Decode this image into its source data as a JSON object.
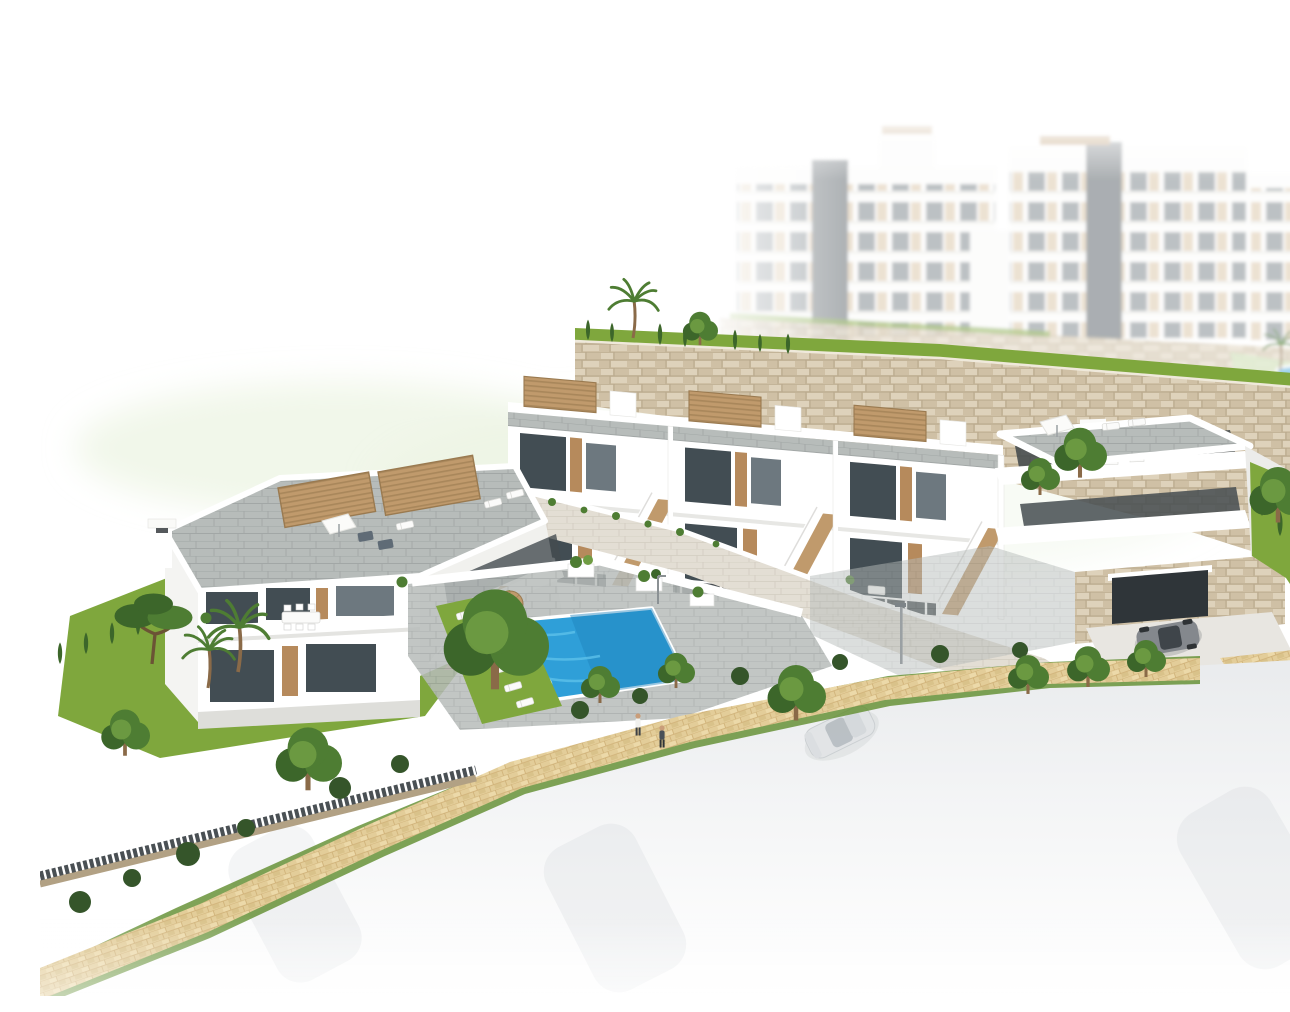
{
  "scene": {
    "caption": "Aerial 3D architectural rendering of a white Mediterranean hillside residential development: a front row of terraced townhouses with tan rooftop pergolas and external staircases, a duplex villa on the left, a communal blue swimming pool with sun loungers and straw parasols, landscaped gardens with pines, palms and cypresses, a beige cobbled footpath, a stone retaining wall, hazy white apartment blocks on the hill behind, and a faded white street with cars in the foreground.",
    "setting": "hillside residential development render, white background",
    "inventory": {
      "background_apartment_blocks": 3,
      "townhouse_units_front_row": 4,
      "corner_townhouse": 1,
      "detached_villa_duplex": 1,
      "swimming_pools": 2,
      "sun_loungers_poolside": 6,
      "parasols_poolside": 2,
      "rooftop_pergolas": 6,
      "pedestrians_on_path": 2,
      "person_on_lounger": 1,
      "person_in_pool": 1,
      "parked_cars_faded": 3,
      "sedan_on_street": 1,
      "sports_car_at_garage": 1,
      "street_lamps": 2
    }
  },
  "colors": {
    "background": "#ffffff",
    "haze_green": "#e7f1dc",
    "building_white": "#ffffff",
    "building_shade": "#f1f1ee",
    "building_dark_face": "#e4e4e1",
    "glass_dark": "#424d53",
    "glass_mid": "#6d787f",
    "frame_dark": "#2e3437",
    "wood_tan": "#c09a6c",
    "wood_dark": "#9a7a50",
    "door_tan": "#b68a5c",
    "roof_paver": "#b7bcba",
    "roof_paver_line": "#a0a6a4",
    "stone_base": "#cfc0a5",
    "stone_dark": "#b2a184",
    "stone_light": "#ded2bb",
    "wall_light": "#e3ded4",
    "wall_light_line": "#cdc7ba",
    "pool_blue": "#2f9fd8",
    "pool_blue_light": "#5cc0ea",
    "pool_blue_deep": "#1f83bd",
    "grass": "#7fa73d",
    "grass_dark": "#5f8c2d",
    "tree_green": "#4e7d33",
    "tree_green_dark": "#3c662a",
    "tree_green_light": "#6f9c43",
    "hedge_dark": "#35552a",
    "path_beige": "#e3cd99",
    "path_tile_line": "#c9a96e",
    "road_gray": "#eceef0",
    "car_silver": "#dfe2e4",
    "car_dark": "#84888d",
    "railing_dark": "#4a5054",
    "trunk_brown": "#8a6a48",
    "skin": "#c99d79",
    "accent_red": "#c4574a"
  }
}
